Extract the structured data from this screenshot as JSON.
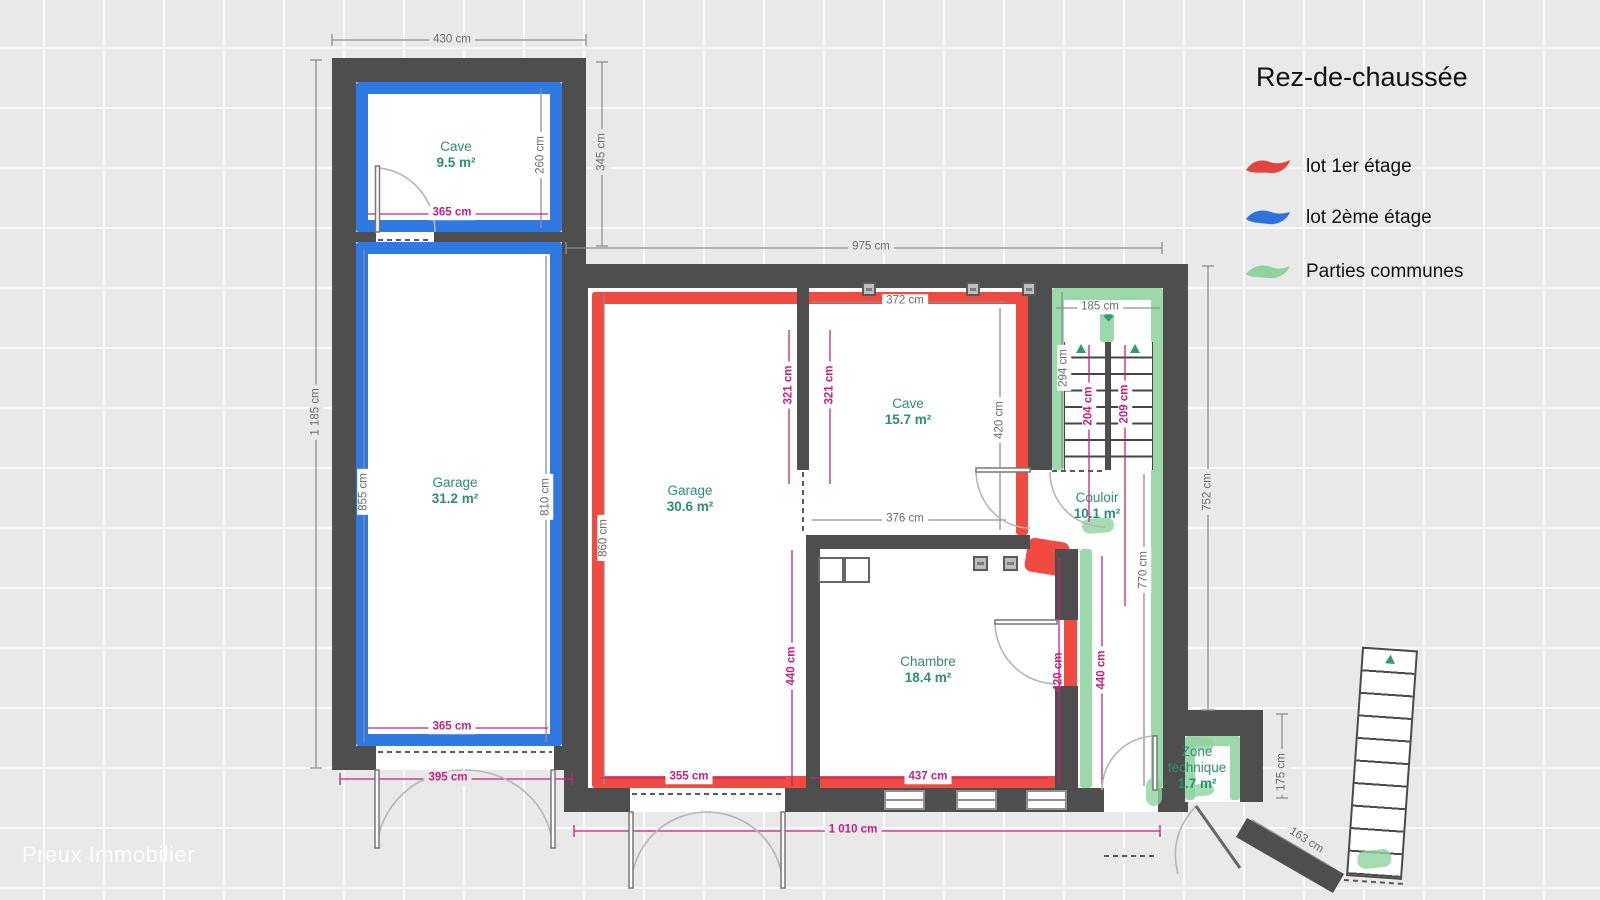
{
  "title": "Rez-de-chaussée",
  "watermark": "Preux Immobilier",
  "legend": {
    "items": [
      {
        "label": "lot 1er étage",
        "color": "#e0463e"
      },
      {
        "label": "lot 2ème étage",
        "color": "#2e72dd"
      },
      {
        "label": "Parties communes",
        "color": "#8fd3a0"
      }
    ]
  },
  "rooms": [
    {
      "name": "Cave",
      "area": "9.5 m²"
    },
    {
      "name": "Garage",
      "area": "31.2 m²"
    },
    {
      "name": "Garage",
      "area": "30.6 m²"
    },
    {
      "name": "Cave",
      "area": "15.7 m²"
    },
    {
      "name": "Chambre",
      "area": "18.4 m²"
    },
    {
      "name": "Couloir",
      "area": "10.1 m²"
    },
    {
      "name": "Zone technique",
      "area": "1.7 m²"
    }
  ],
  "dims": [
    "430 cm",
    "345 cm",
    "260 cm",
    "365 cm",
    "1 185 cm",
    "855 cm",
    "810 cm",
    "365 cm",
    "395 cm",
    "975 cm",
    "372 cm",
    "321 cm",
    "321 cm",
    "860 cm",
    "420 cm",
    "376 cm",
    "185 cm",
    "294 cm",
    "204 cm",
    "209 cm",
    "752 cm",
    "770 cm",
    "440 cm",
    "420 cm",
    "440 cm",
    "355 cm",
    "437 cm",
    "1 010 cm",
    "175 cm",
    "163 cm"
  ],
  "colors": {
    "wall": "#4e4e4e",
    "lot1": "#f04a41",
    "lot2": "#3078e2",
    "common": "#9bd8aa",
    "room_label": "#2e8e72",
    "dim_interior": "#c02386",
    "dim_exterior": "#6c6c6c"
  }
}
